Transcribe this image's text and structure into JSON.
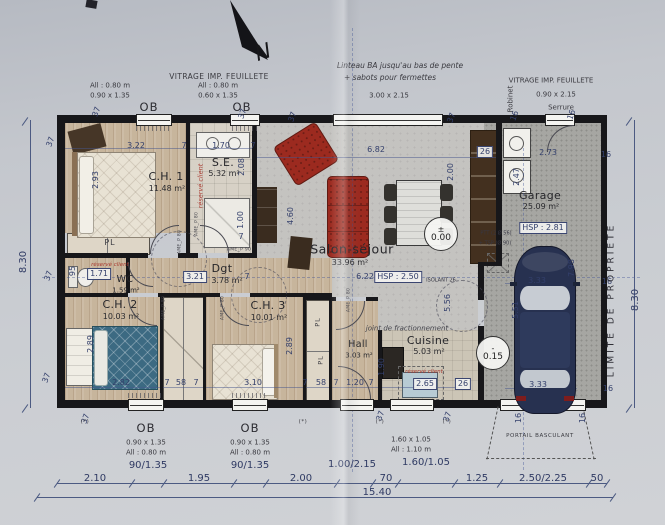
{
  "levels": {
    "salon": {
      "symbol": "±",
      "value": "0.00"
    },
    "garage": {
      "symbol": "-",
      "value": "0.15"
    }
  },
  "rooms": [
    {
      "id": "ch1",
      "name": "C.H. 1",
      "area": "11.48 m²",
      "nx": 166,
      "ny": 177,
      "ax": 167,
      "ay": 189
    },
    {
      "id": "se",
      "name": "S.E.",
      "area": "5.32 m²",
      "nx": 223,
      "ny": 163,
      "ax": 224,
      "ay": 174
    },
    {
      "id": "salon",
      "name": "Salon-séjour",
      "area": "33.96 m²",
      "nx": 352,
      "ny": 249,
      "ax": 350,
      "ay": 263,
      "size": "lg"
    },
    {
      "id": "dgt",
      "name": "Dgt",
      "area": "3.78 m²",
      "nx": 222,
      "ny": 269,
      "ax": 227,
      "ay": 281
    },
    {
      "id": "wc",
      "name": "WC",
      "area": "1.59 m²",
      "nx": 125,
      "ny": 280,
      "ax": 126,
      "ay": 291,
      "size": "sm"
    },
    {
      "id": "ch2",
      "name": "C.H. 2",
      "area": "10.03 m²",
      "nx": 120,
      "ny": 305,
      "ax": 121,
      "ay": 317
    },
    {
      "id": "ch3",
      "name": "C.H. 3",
      "area": "10.01 m²",
      "nx": 268,
      "ny": 306,
      "ax": 269,
      "ay": 318
    },
    {
      "id": "hall",
      "name": "Hall",
      "area": "3.03 m²",
      "nx": 358,
      "ny": 345,
      "ax": 359,
      "ay": 356,
      "size": "sm"
    },
    {
      "id": "cuisine",
      "name": "Cuisine",
      "area": "5.03 m²",
      "nx": 428,
      "ny": 341,
      "ax": 429,
      "ay": 352
    },
    {
      "id": "garage",
      "name": "Garage",
      "area": "25.09 m²",
      "nx": 540,
      "ny": 196,
      "ax": 541,
      "ay": 207
    }
  ],
  "dims": [
    {
      "t": "3.22",
      "x": 136,
      "y": 146
    },
    {
      "t": "7",
      "x": 184,
      "y": 146
    },
    {
      "t": "1.70",
      "x": 221,
      "y": 146
    },
    {
      "t": "7",
      "x": 253,
      "y": 146
    },
    {
      "t": "6.82",
      "x": 376,
      "y": 150
    },
    {
      "t": "26",
      "x": 485,
      "y": 152,
      "c": "boxed"
    },
    {
      "t": "2.73",
      "x": 548,
      "y": 153
    },
    {
      "t": "16",
      "x": 606,
      "y": 155
    },
    {
      "t": "37",
      "x": 97,
      "y": 112,
      "r": -70
    },
    {
      "t": "37",
      "x": 243,
      "y": 114,
      "r": -70
    },
    {
      "t": "37",
      "x": 293,
      "y": 117,
      "r": -70
    },
    {
      "t": "37",
      "x": 452,
      "y": 118,
      "r": -70
    },
    {
      "t": "16",
      "x": 515,
      "y": 116,
      "r": -70
    },
    {
      "t": "16",
      "x": 572,
      "y": 115,
      "r": -70
    },
    {
      "t": "37",
      "x": 51,
      "y": 142,
      "r": -70
    },
    {
      "t": "37",
      "x": 49,
      "y": 276,
      "r": -70
    },
    {
      "t": "37",
      "x": 47,
      "y": 378,
      "r": -70
    },
    {
      "t": "37",
      "x": 86,
      "y": 419,
      "r": -70
    },
    {
      "t": "37",
      "x": 381,
      "y": 416,
      "r": -70
    },
    {
      "t": "37",
      "x": 448,
      "y": 417,
      "r": -70
    },
    {
      "t": "8.30",
      "x": 24,
      "y": 262,
      "r": -90,
      "c": "big"
    },
    {
      "t": "8.30",
      "x": 636,
      "y": 300,
      "r": -90,
      "c": "big"
    },
    {
      "t": "2.93",
      "x": 96,
      "y": 180,
      "r": -90
    },
    {
      "t": "2.08",
      "x": 242,
      "y": 167,
      "r": -90
    },
    {
      "t": "1.00",
      "x": 241,
      "y": 220,
      "r": -90
    },
    {
      "t": "7",
      "x": 241,
      "y": 237
    },
    {
      "t": "4.60",
      "x": 291,
      "y": 216,
      "r": -90
    },
    {
      "t": "2.00",
      "x": 451,
      "y": 172,
      "r": -90
    },
    {
      "t": "2.47",
      "x": 517,
      "y": 177,
      "r": -90
    },
    {
      "t": "95",
      "x": 73,
      "y": 271,
      "r": -90
    },
    {
      "t": "5.56",
      "x": 448,
      "y": 303,
      "r": -90
    },
    {
      "t": "1.90",
      "x": 382,
      "y": 367,
      "r": -90
    },
    {
      "t": "2.89",
      "x": 91,
      "y": 344,
      "r": -90
    },
    {
      "t": "2.89",
      "x": 290,
      "y": 346,
      "r": -90
    },
    {
      "t": "7.98",
      "x": 572,
      "y": 268,
      "r": -90
    },
    {
      "t": "5.51",
      "x": 516,
      "y": 310,
      "r": -90
    },
    {
      "t": "16",
      "x": 519,
      "y": 418,
      "r": -90
    },
    {
      "t": "16",
      "x": 583,
      "y": 418,
      "r": -90
    },
    {
      "t": "1.71",
      "x": 99,
      "y": 274,
      "c": "boxed"
    },
    {
      "t": "3.21",
      "x": 195,
      "y": 277,
      "c": "boxed"
    },
    {
      "t": "7",
      "x": 247,
      "y": 277
    },
    {
      "t": "6.22",
      "x": 365,
      "y": 277
    },
    {
      "t": "HSP : 2.50",
      "x": 398,
      "y": 277,
      "c": "boxed"
    },
    {
      "t": "ISOLANT 26",
      "x": 441,
      "y": 281,
      "c": "tiny"
    },
    {
      "t": "HSP : 2.81",
      "x": 543,
      "y": 228,
      "c": "boxed"
    },
    {
      "t": "16",
      "x": 607,
      "y": 282
    },
    {
      "t": "16",
      "x": 608,
      "y": 389
    },
    {
      "t": "PTT (2 Ø 56)",
      "x": 496,
      "y": 234,
      "c": "tiny"
    },
    {
      "t": "+ TSP (Ø 90)",
      "x": 495,
      "y": 244,
      "c": "tiny"
    },
    {
      "t": "3.33",
      "x": 537,
      "y": 281
    },
    {
      "t": "3.33",
      "x": 538,
      "y": 385
    },
    {
      "t": "2.82",
      "x": 121,
      "y": 383
    },
    {
      "t": "7",
      "x": 167,
      "y": 383
    },
    {
      "t": "58",
      "x": 181,
      "y": 383
    },
    {
      "t": "7",
      "x": 196,
      "y": 383
    },
    {
      "t": "3.10",
      "x": 253,
      "y": 383
    },
    {
      "t": "7",
      "x": 305,
      "y": 383
    },
    {
      "t": "58",
      "x": 321,
      "y": 383
    },
    {
      "t": "7",
      "x": 336,
      "y": 383
    },
    {
      "t": "1.20",
      "x": 355,
      "y": 383
    },
    {
      "t": "7",
      "x": 371,
      "y": 383
    },
    {
      "t": "2.65",
      "x": 425,
      "y": 384,
      "c": "boxed"
    },
    {
      "t": "26",
      "x": 463,
      "y": 384,
      "c": "boxed"
    }
  ],
  "notes": [
    {
      "t": "VITRAGE IMP. FEUILLETE",
      "x": 219,
      "y": 77,
      "c": "note",
      "n": "note-vitrage-top-left"
    },
    {
      "t": "All : 0.80 m",
      "x": 110,
      "y": 86,
      "c": "small"
    },
    {
      "t": "0.90 x 1.35",
      "x": 110,
      "y": 96,
      "c": "small"
    },
    {
      "t": "All : 0.80 m",
      "x": 218,
      "y": 86,
      "c": "small"
    },
    {
      "t": "0.60 x 1.35",
      "x": 218,
      "y": 96,
      "c": "small"
    },
    {
      "t": "OB",
      "x": 149,
      "y": 107,
      "c": "ob",
      "n": "window-label-ob"
    },
    {
      "t": "OB",
      "x": 242,
      "y": 107,
      "c": "ob",
      "n": "window-label-ob"
    },
    {
      "t": "Linteau BA jusqu'au bas de pente",
      "x": 400,
      "y": 66,
      "c": "italic",
      "n": "note-linteau"
    },
    {
      "t": "+ sabots pour fermettes",
      "x": 390,
      "y": 78,
      "c": "italic"
    },
    {
      "t": "3.00 x 2.15",
      "x": 389,
      "y": 96,
      "c": "small"
    },
    {
      "t": "VITRAGE IMP. FEUILLETE",
      "x": 551,
      "y": 81,
      "c": "small",
      "n": "note-vitrage-top-right"
    },
    {
      "t": "0.90 x 2.15",
      "x": 556,
      "y": 95,
      "c": "small"
    },
    {
      "t": "Serrure",
      "x": 561,
      "y": 108,
      "c": "small"
    },
    {
      "t": "Robinet",
      "x": 511,
      "y": 99,
      "c": "small",
      "r": -90
    },
    {
      "t": "N",
      "x": 263,
      "y": 52,
      "c": "north",
      "r": -18,
      "n": "north-letter"
    },
    {
      "t": "réservé client",
      "x": 201,
      "y": 186,
      "c": "red",
      "r": -90
    },
    {
      "t": "réservé client",
      "x": 110,
      "y": 266,
      "c": "redxs"
    },
    {
      "t": "réservé client",
      "x": 424,
      "y": 373,
      "c": "redxs"
    },
    {
      "t": "joint de fractionnement",
      "x": 407,
      "y": 329,
      "c": "italicsm",
      "n": "note-joint-fractionnement"
    },
    {
      "t": "PL",
      "x": 110,
      "y": 243,
      "c": "pl",
      "n": "closet-label"
    },
    {
      "t": "PL",
      "x": 318,
      "y": 322,
      "c": "plsm",
      "r": -90,
      "n": "closet-label"
    },
    {
      "t": "PL",
      "x": 321,
      "y": 360,
      "c": "plsm",
      "r": -90,
      "n": "closet-label"
    },
    {
      "t": "LIMITE  DE  PROPRIETE",
      "x": 612,
      "y": 300,
      "c": "limite",
      "r": -90,
      "n": "limite-propriete-label"
    },
    {
      "t": "PORTAIL BASCULANT",
      "x": 540,
      "y": 437,
      "c": "tinycap",
      "n": "note-portail-basculant"
    },
    {
      "t": "OB",
      "x": 146,
      "y": 428,
      "c": "ob",
      "n": "window-label-ob"
    },
    {
      "t": "0.90 x 1.35",
      "x": 146,
      "y": 443,
      "c": "small"
    },
    {
      "t": "All : 0.80 m",
      "x": 146,
      "y": 453,
      "c": "small"
    },
    {
      "t": "OB",
      "x": 250,
      "y": 428,
      "c": "ob",
      "n": "window-label-ob"
    },
    {
      "t": "0.90 x 1.35",
      "x": 250,
      "y": 443,
      "c": "small"
    },
    {
      "t": "All : 0.80 m",
      "x": 250,
      "y": 453,
      "c": "small"
    },
    {
      "t": "1.60 x 1.05",
      "x": 411,
      "y": 440,
      "c": "small"
    },
    {
      "t": "All : 1.10 m",
      "x": 411,
      "y": 450,
      "c": "small"
    },
    {
      "t": "(*)",
      "x": 85,
      "y": 423,
      "c": "tinycap"
    },
    {
      "t": "(*)",
      "x": 303,
      "y": 423,
      "c": "tinycap"
    },
    {
      "t": "(*)",
      "x": 380,
      "y": 423,
      "c": "tinycap"
    },
    {
      "t": "(*)",
      "x": 447,
      "y": 423,
      "c": "tinycap"
    },
    {
      "t": "AME_P 80",
      "x": 198,
      "y": 224,
      "c": "door",
      "r": -90
    },
    {
      "t": "AME_P 80",
      "x": 181,
      "y": 242,
      "c": "door",
      "r": -90
    },
    {
      "t": "AME_P 90",
      "x": 239,
      "y": 251,
      "c": "door"
    },
    {
      "t": "AME_P 80",
      "x": 165,
      "y": 308,
      "c": "door",
      "r": -90
    },
    {
      "t": "AME_P 80",
      "x": 224,
      "y": 308,
      "c": "door",
      "r": -90
    },
    {
      "t": "AME_P 80",
      "x": 350,
      "y": 300,
      "c": "door",
      "r": -90
    }
  ],
  "chain": {
    "segments": [
      {
        "t": "2.10",
        "x": 95,
        "y": 479
      },
      {
        "t": "90/1.35",
        "x": 148,
        "y": 466
      },
      {
        "t": "1.95",
        "x": 199,
        "y": 479
      },
      {
        "t": "90/1.35",
        "x": 250,
        "y": 466
      },
      {
        "t": "2.00",
        "x": 301,
        "y": 479
      },
      {
        "t": "1.00/2.15",
        "x": 352,
        "y": 465
      },
      {
        "t": "70",
        "x": 386,
        "y": 479
      },
      {
        "t": "1.60/1.05",
        "x": 426,
        "y": 463
      },
      {
        "t": "1.25",
        "x": 477,
        "y": 479
      },
      {
        "t": "2.50/2.25",
        "x": 543,
        "y": 479
      },
      {
        "t": "50",
        "x": 597,
        "y": 479
      }
    ],
    "total": {
      "t": "15.40",
      "x": 377,
      "y": 493
    }
  }
}
